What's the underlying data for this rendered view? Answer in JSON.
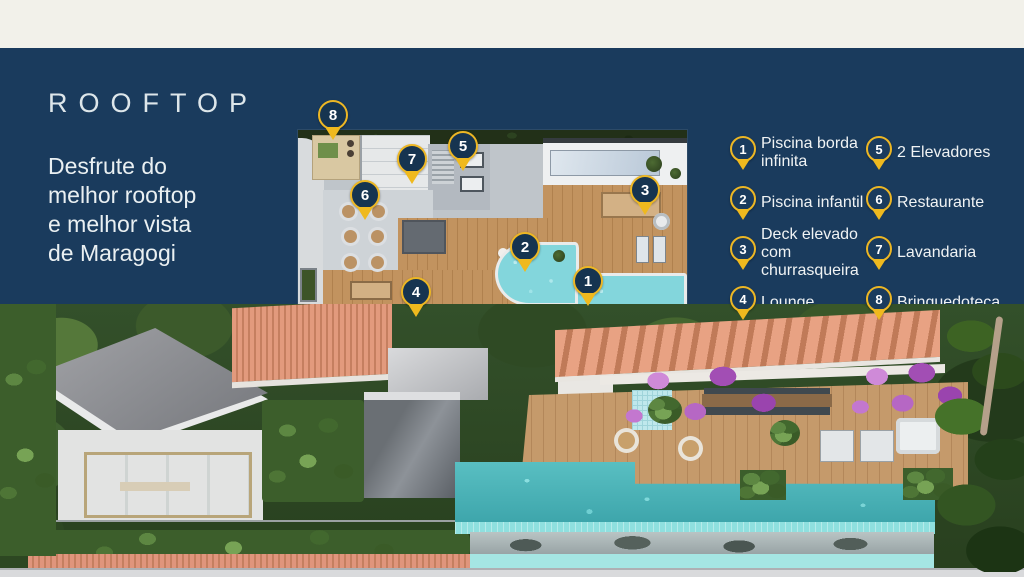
{
  "intro": {
    "title": "ROOFTOP",
    "subtitle": "Desfrute do\nmelhor rooftop\ne melhor vista\nde Maragogi"
  },
  "legend": {
    "items": [
      {
        "num": "1",
        "label": "Piscina borda infinita"
      },
      {
        "num": "2",
        "label": "Piscina infantil"
      },
      {
        "num": "3",
        "label": "Deck elevado com churrasqueira"
      },
      {
        "num": "4",
        "label": "Lounge"
      },
      {
        "num": "5",
        "label": "2 Elevadores"
      },
      {
        "num": "6",
        "label": "Restaurante"
      },
      {
        "num": "7",
        "label": "Lavandaria"
      },
      {
        "num": "8",
        "label": "Brinquedoteca"
      }
    ]
  },
  "colors": {
    "navy_panel": "#1a3b5d",
    "cream_bar": "#f2f1ea",
    "pin_yellow": "#edb724",
    "pin_circle": "#163450",
    "pool_turquoise": "#59bfc2",
    "deck_wood": "#c2935f",
    "bougainvillea": "#b667c4"
  }
}
